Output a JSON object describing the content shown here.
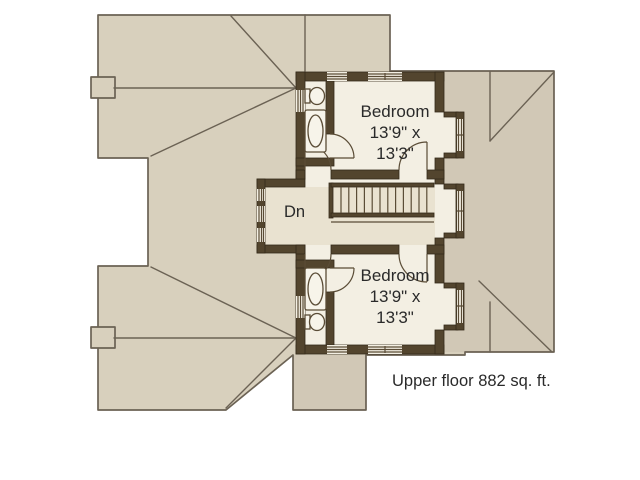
{
  "colors": {
    "roof_fill": "#d8d0bd",
    "roof_line": "#6b6254",
    "wall_color": "#53452e",
    "interior_fill": "#f3efe3",
    "hall_fill": "#e9e2d0",
    "door_line": "#5a4c36",
    "text_color": "#2a2a2a",
    "background": "#ffffff"
  },
  "plan": {
    "caption": "Upper floor 882 sq. ft.",
    "stair_label": "Dn",
    "rooms": [
      {
        "name": "Bedroom",
        "size_line1": "13'9\" x",
        "size_line2": "13'3\"",
        "position": "top"
      },
      {
        "name": "Bedroom",
        "size_line1": "13'9\" x",
        "size_line2": "13'3\"",
        "position": "bottom"
      }
    ]
  }
}
